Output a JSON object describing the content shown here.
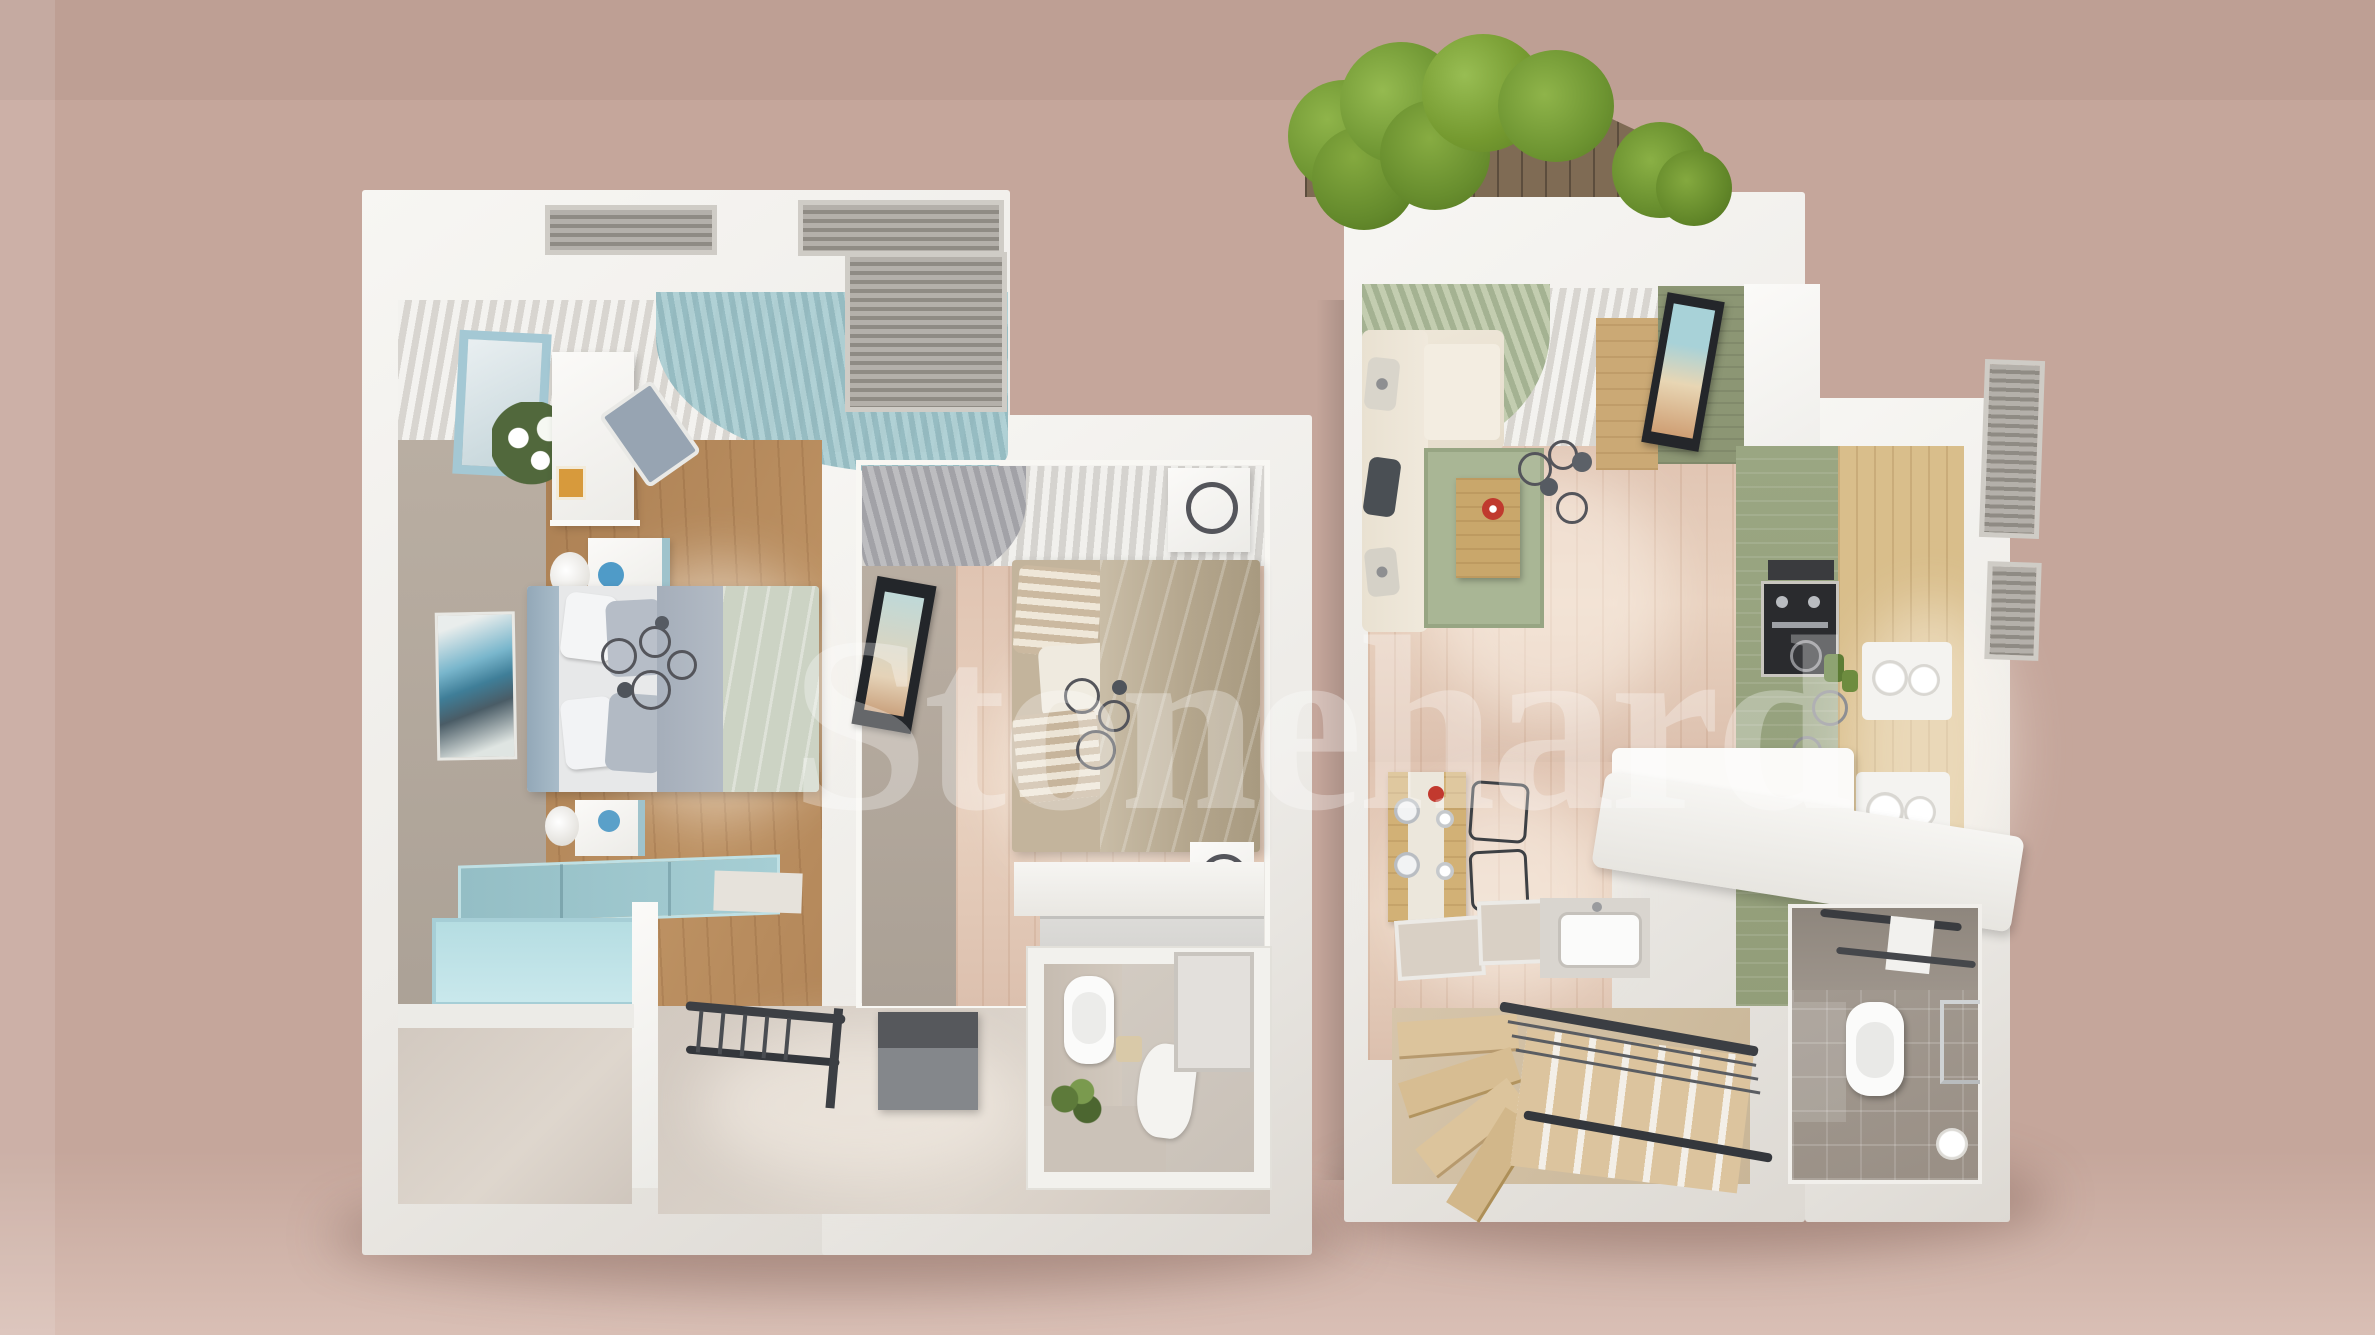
{
  "watermark": {
    "text": "Stonehard"
  },
  "scene": {
    "type": "3d-floor-plan-render",
    "description": "Top-down 3D rendering of a two-block maisonette floor plan on a dusty rose background",
    "background_color": "#c5a69b",
    "palette": {
      "wall_white": "#f2f1ee",
      "greige_wall": "#b3a89c",
      "wood_floor": "#d6ba98",
      "pink_wood_floor": "#e3c9b6",
      "teal_accent": "#9fc8cd",
      "sage_rug": "#a9b695",
      "kitchen_green": "#96a17d",
      "cabinet_wood": "#d9be8b",
      "hedge_green": "#7ca03a",
      "bed_duvet_sage": "#ccd3c4",
      "bed2_duvet_tan": "#b4a68d"
    }
  },
  "units": {
    "left_block": {
      "rooms": [
        "bedroom-1",
        "bedroom-2",
        "bathroom",
        "hallway",
        "storage-room",
        "teal-bench-balcony"
      ]
    },
    "right_block": {
      "rooms": [
        "living-room",
        "kitchen",
        "dining-area",
        "staircase",
        "bathroom",
        "roof-hedge-terrace"
      ]
    }
  }
}
